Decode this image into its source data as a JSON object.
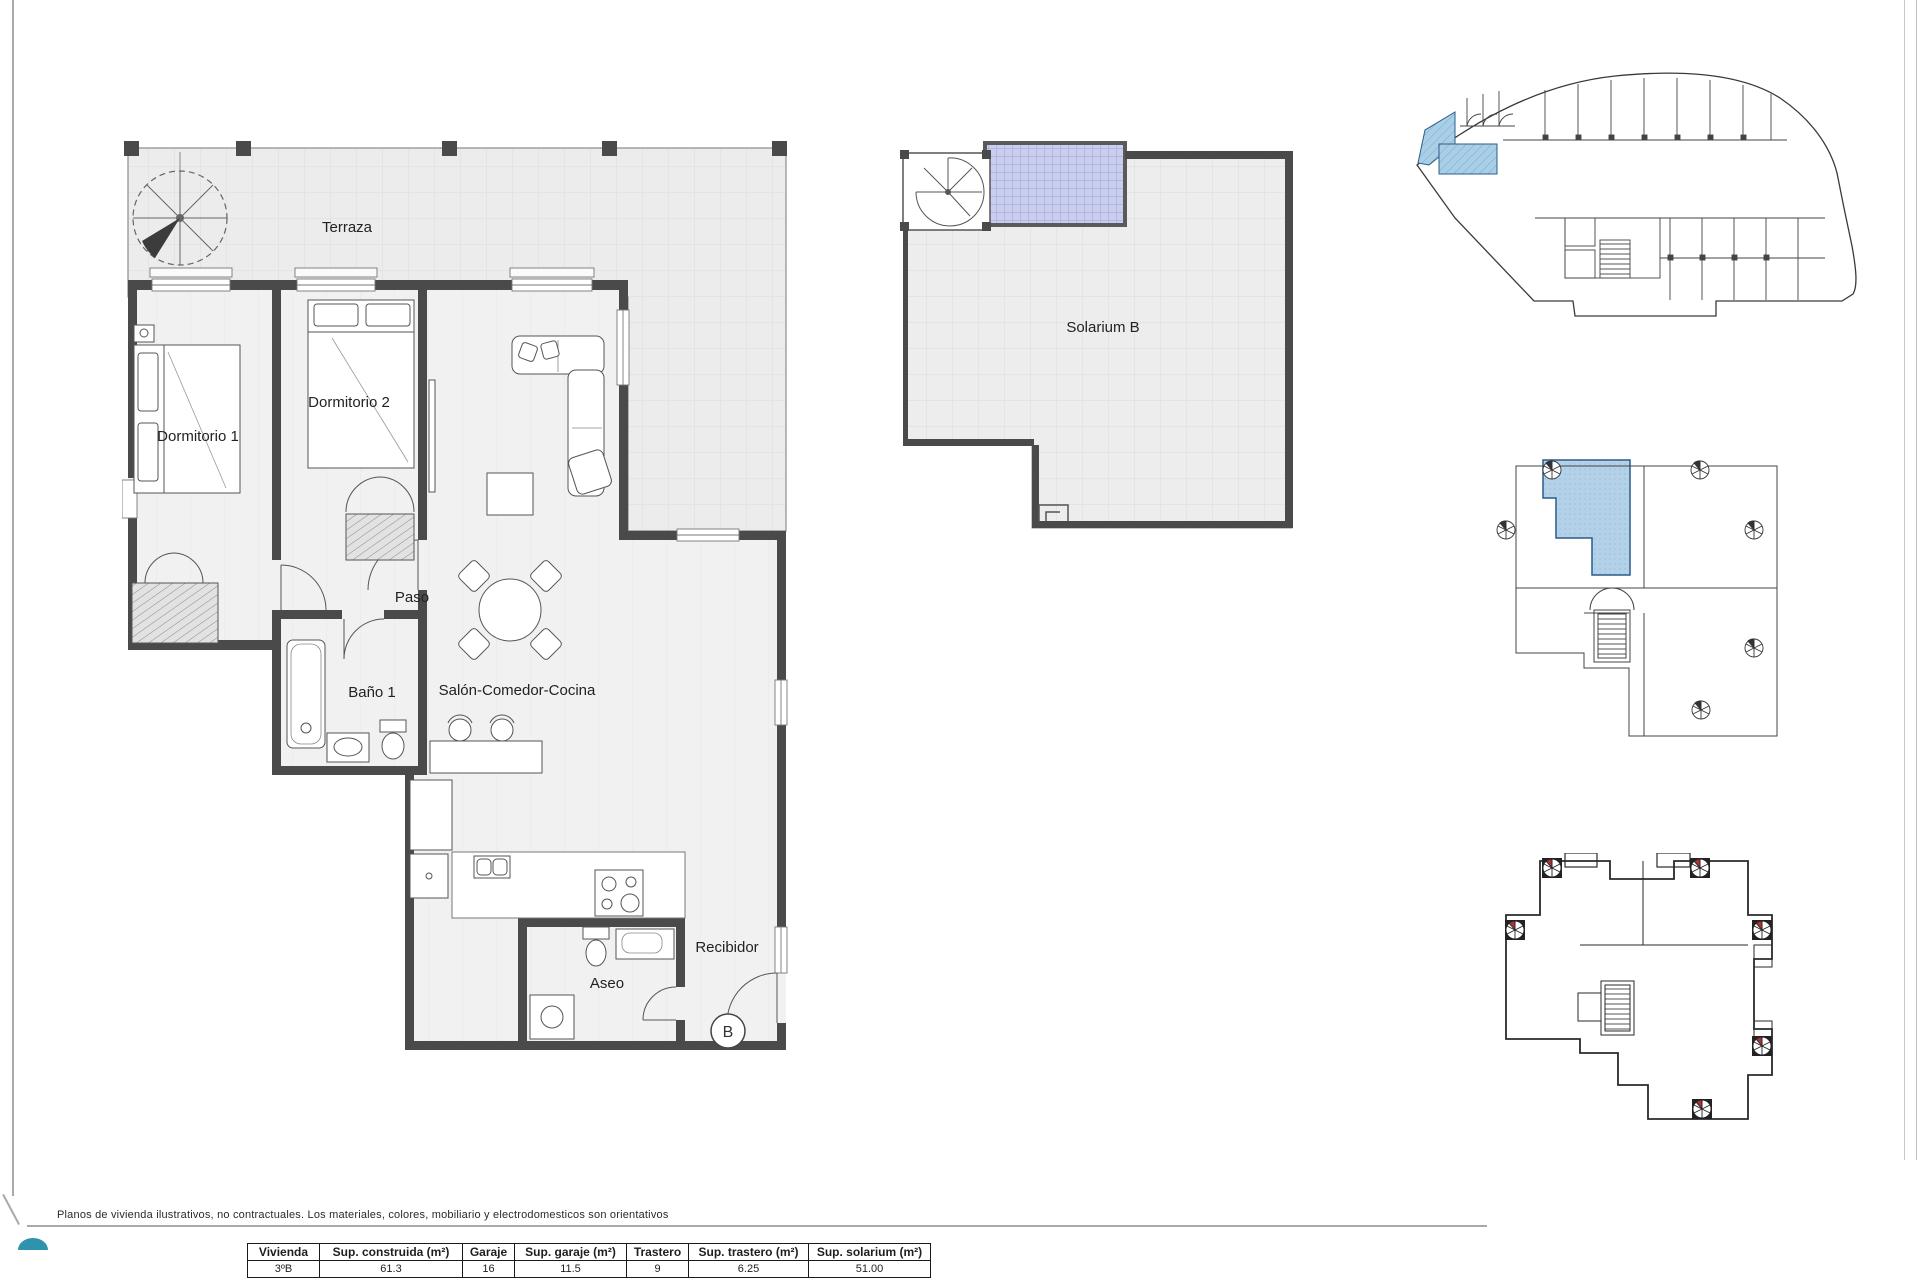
{
  "sheet": {
    "footer_note": "Planos de vivienda ilustrativos, no contractuales. Los materiales, colores, mobiliario y electrodomesticos son orientativos"
  },
  "floor_plan": {
    "labels": {
      "terraza": "Terraza",
      "dormitorio1": "Dormitorio 1",
      "dormitorio2": "Dormitorio 2",
      "paso": "Paso",
      "bano1": "Baño 1",
      "salon": "Salón-Comedor-Cocina",
      "aseo": "Aseo",
      "recibidor": "Recibidor",
      "unit": "B"
    }
  },
  "solarium_plan": {
    "label": "Solarium B"
  },
  "summary_table": {
    "headers": [
      "Vivienda",
      "Sup. construida (m²)",
      "Garaje",
      "Sup. garaje (m²)",
      "Trastero",
      "Sup. trastero (m²)",
      "Sup. solarium (m²)"
    ],
    "row": [
      "3ºB",
      "61.3",
      "16",
      "11.5",
      "9",
      "6.25",
      "51.00"
    ]
  },
  "colors": {
    "wall": "#4a4a4a",
    "floor": "#efefef",
    "solarium_highlight": "#c9cdee",
    "unit_highlight": "#b3d1e8",
    "logo_teal": "#2f93ae"
  }
}
